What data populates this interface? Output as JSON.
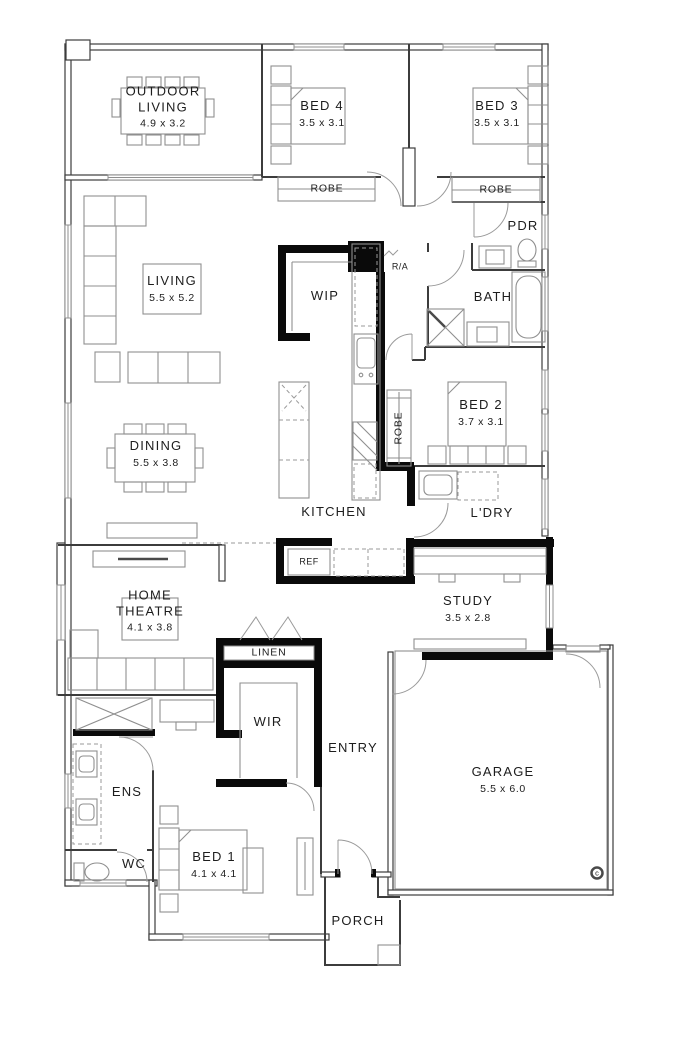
{
  "plan": {
    "rooms": {
      "outdoor_living": {
        "name": "OUTDOOR LIVING",
        "dims": "4.9 x 3.2"
      },
      "bed4": {
        "name": "BED 4",
        "dims": "3.5 x 3.1"
      },
      "bed3": {
        "name": "BED 3",
        "dims": "3.5 x 3.1"
      },
      "living": {
        "name": "LIVING",
        "dims": "5.5 x 5.2"
      },
      "wip": {
        "name": "WIP"
      },
      "pdr": {
        "name": "PDR"
      },
      "bath": {
        "name": "BATH"
      },
      "bed2": {
        "name": "BED 2",
        "dims": "3.7 x 3.1"
      },
      "dining": {
        "name": "DINING",
        "dims": "5.5 x 3.8"
      },
      "kitchen": {
        "name": "KITCHEN"
      },
      "ldry": {
        "name": "L'DRY"
      },
      "home_theatre": {
        "name": "HOME THEATRE",
        "dims": "4.1 x 3.8"
      },
      "study": {
        "name": "STUDY",
        "dims": "3.5 x 2.8"
      },
      "linen": {
        "name": "LINEN"
      },
      "wir": {
        "name": "WIR"
      },
      "entry": {
        "name": "ENTRY"
      },
      "garage": {
        "name": "GARAGE",
        "dims": "5.5 x 6.0"
      },
      "ens": {
        "name": "ENS"
      },
      "wc": {
        "name": "WC"
      },
      "bed1": {
        "name": "BED 1",
        "dims": "4.1 x 4.1"
      },
      "porch": {
        "name": "PORCH"
      }
    },
    "fixtures": {
      "robe": "ROBE",
      "ref": "REF",
      "return_air": "R/A",
      "copyright": "c"
    },
    "colors": {
      "wall": "#3c3c3c",
      "solid_wall": "#0a0a0a",
      "furniture": "#8f8f8f",
      "text": "#1d1d1d",
      "background": "#ffffff"
    }
  }
}
